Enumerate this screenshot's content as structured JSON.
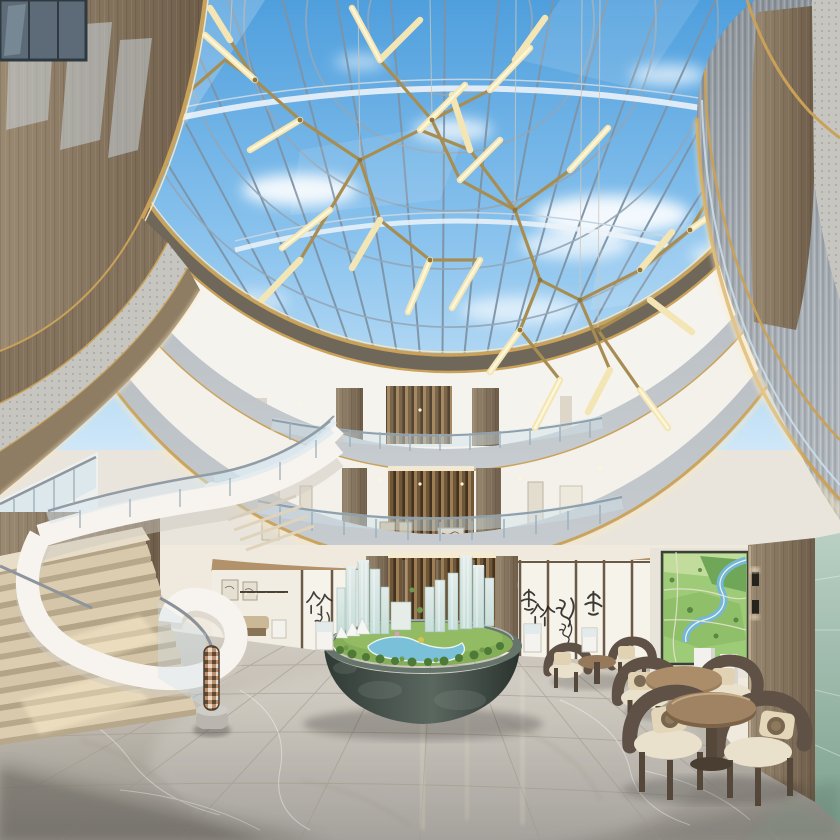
{
  "scene": {
    "type": "architectural-interior-rendering",
    "setting": "multi-storey sales-center atrium lobby with oval glass skylight",
    "floors_visible": 3,
    "skylight": {
      "shape": "oval glass roof",
      "sky": "blue sky with white clouds",
      "structure": "steel mullion grid"
    },
    "chandelier": {
      "style": "branching brass rods with linear light tubes",
      "tube_count": 26
    },
    "staircase": {
      "style": "curved white ribbon grand stair with glass balustrade",
      "steps_visible": 11
    },
    "model_basin": {
      "container": "oval dark stone basin",
      "contents": "miniature masterplan: glass towers, lawn, pool, trees, sail canopies",
      "tower_count": 11
    },
    "calligraphy_wall": {
      "panel_count": 11,
      "ink_marks": 7
    },
    "mural": "aerial landscape masterplan artwork",
    "seating_groups": 3
  },
  "palette": {
    "sky_top": "#4f9fdd",
    "sky_mid": "#8cc4ee",
    "sky_low": "#cfe7f8",
    "cloud": "#ffffff",
    "mullion": "#7e93a6",
    "beam_white": "#ecf3f8",
    "brass": "#a88d52",
    "tube_warm": "#f3e5b4",
    "tube_core": "#fff7da",
    "gold_trim": "#c9a158",
    "gold_bright": "#ffe9bb",
    "fascia_base": "#a9b0b6",
    "fascia_stripe": "#8d959c",
    "wall_white": "#f4f2ed",
    "wood_light": "#a38c6c",
    "wood_mid": "#8b7256",
    "wood_dark": "#6b583f",
    "glass_tint": "#cfe2ec",
    "rail_steel": "#8e969e",
    "floor_light": "#d8d3ca",
    "floor_mid": "#c2bcb1",
    "floor_dark": "#94908a",
    "bowl_dark": "#303a35",
    "bowl_mid": "#5a675f",
    "lawn": "#85ae58",
    "pool": "#79c0d8",
    "tree": "#4d7a36",
    "tower_glass": "#c8ded9",
    "mural_green": "#9ecb77",
    "mural_river": "#74b7d6",
    "screen_white": "#f6f3ea",
    "frame_wood": "#6b5a45",
    "ink": "#23211d",
    "cushion": "#eae1cc",
    "chair_wood": "#5f5146"
  }
}
